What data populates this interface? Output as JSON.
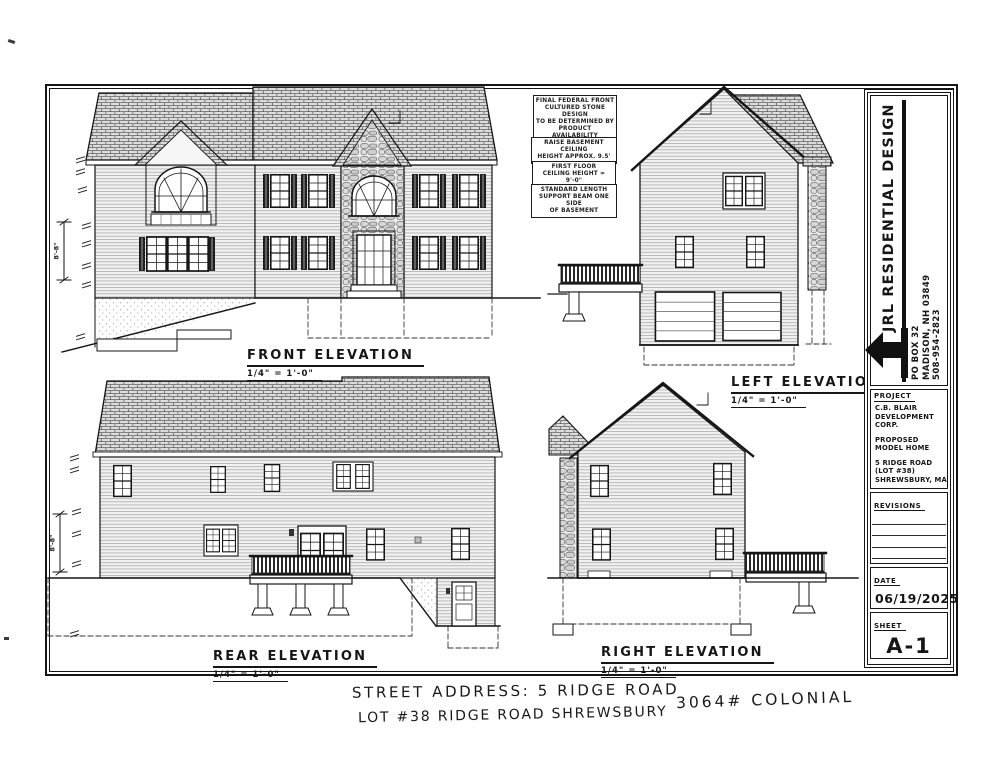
{
  "colors": {
    "ink": "#161616",
    "paper": "#ffffff"
  },
  "notes": [
    {
      "lines": [
        "FINAL FEDERAL FRONT",
        "CULTURED STONE DESIGN",
        "TO BE DETERMINED BY",
        "PRODUCT AVAILABILITY"
      ]
    },
    {
      "lines": [
        "RAISE BASEMENT CEILING",
        "HEIGHT APPROX. 9.5'"
      ]
    },
    {
      "lines": [
        "FIRST FLOOR",
        "CEILING HEIGHT = 9'-0\""
      ]
    },
    {
      "lines": [
        "STANDARD LENGTH",
        "SUPPORT BEAM ONE SIDE",
        "OF BASEMENT"
      ]
    }
  ],
  "elevations": {
    "front": {
      "label": "FRONT ELEVATION",
      "scale": "1/4\" = 1'-0\""
    },
    "left": {
      "label": "LEFT ELEVATION",
      "scale": "1/4\" = 1'-0\""
    },
    "rear": {
      "label": "REAR ELEVATION",
      "scale": "1/4\" = 1'-0\""
    },
    "right": {
      "label": "RIGHT ELEVATION",
      "scale": "1/4\" = 1'-0\""
    }
  },
  "dimensions": {
    "front_height": "8'-8\"",
    "rear_height": "8'-8\""
  },
  "title_block": {
    "company": "JRL RESIDENTIAL DESIGN",
    "address": [
      "PO BOX 32",
      "MADISON, NH 03849",
      "508-954-2823"
    ],
    "project_label": "PROJECT",
    "project": [
      "C.B. BLAIR",
      "DEVELOPMENT",
      "CORP.",
      "PROPOSED",
      "MODEL HOME",
      "5 RIDGE ROAD",
      "(LOT #38)",
      "SHREWSBURY, MA"
    ],
    "revisions_label": "REVISIONS",
    "date_label": "DATE",
    "date": "06/19/2025",
    "sheet_label": "SHEET",
    "sheet": "A-1"
  },
  "handwritten": {
    "line1": "STREET ADDRESS: 5 RIDGE ROAD",
    "line2": "LOT #38 RIDGE ROAD SHREWSBURY",
    "tag": "3064# COLONIAL"
  }
}
